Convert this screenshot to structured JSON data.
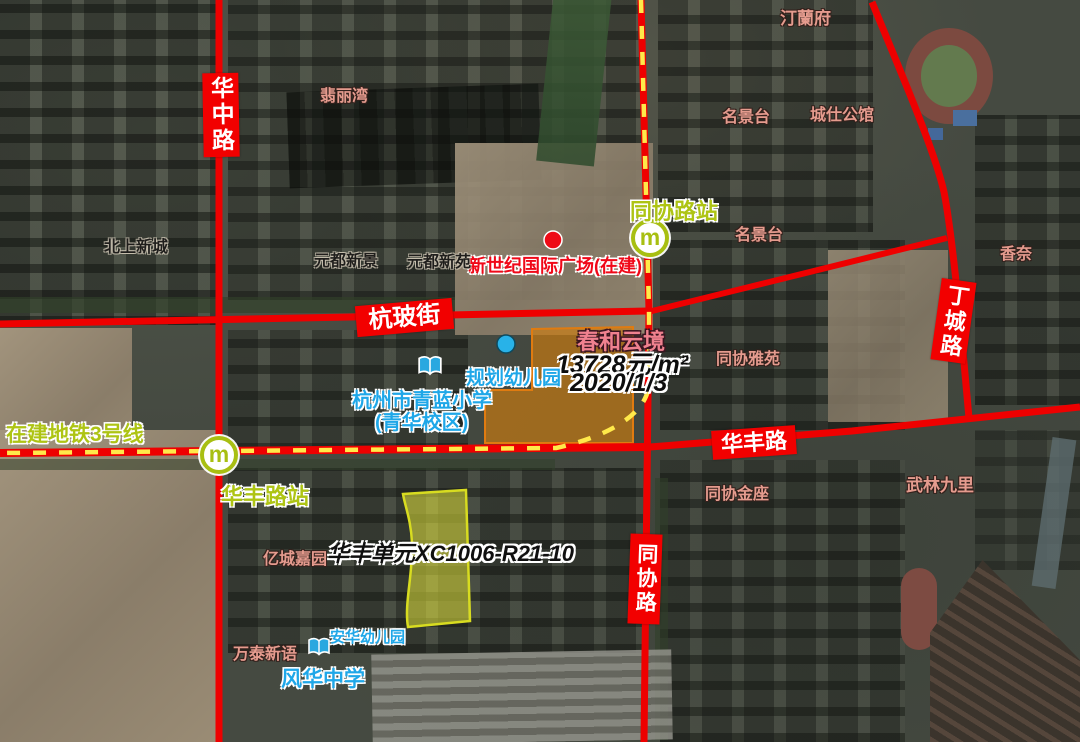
{
  "roads": {
    "huazhong": "华中路",
    "hangbo": "杭玻街",
    "huafeng": "华丰路",
    "tongxie": "同协路",
    "dingcheng": "丁城路"
  },
  "metro": {
    "line_label": "在建地铁3号线",
    "station_tongxie": "同协路站",
    "station_huafeng": "华丰路站",
    "logo_letter": "m"
  },
  "listing": {
    "name": "春和云境",
    "price": "13728元/m²",
    "date": "2020/1/3"
  },
  "parcel": {
    "label": "华丰单元XC1006-R21-10"
  },
  "pois": {
    "plaza": "新世纪国际广场(在建)",
    "planned_kindergarten": "规划幼儿园",
    "school_line1": "杭州市青蓝小学",
    "school_line2": "(青华校区)",
    "kindergarten": "安华幼儿园",
    "middle_school": "风华中学"
  },
  "communities": [
    {
      "text": "汀蘭府"
    },
    {
      "text": "翡丽湾"
    },
    {
      "text": "名景台"
    },
    {
      "text": "城仕公馆"
    },
    {
      "text": "名景台"
    },
    {
      "text": "香奈"
    },
    {
      "text": "北上新城"
    },
    {
      "text": "元都新景"
    },
    {
      "text": "元都新苑"
    },
    {
      "text": "同协雅苑"
    },
    {
      "text": "同协金座"
    },
    {
      "text": "武林九里"
    },
    {
      "text": "亿城嘉园"
    },
    {
      "text": "万泰新语"
    }
  ],
  "colors": {
    "road_red": "#ee0000",
    "metro_dash_yellow": "#ffe94a",
    "station_green": "#aec414",
    "community_salmon": "#e59b8e",
    "poi_blue": "#1fa7e8",
    "listing_pink": "#f0818f",
    "parcel_orange_fill": "#cd7d0f",
    "parcel_yellow_fill": "#e3e63e"
  }
}
